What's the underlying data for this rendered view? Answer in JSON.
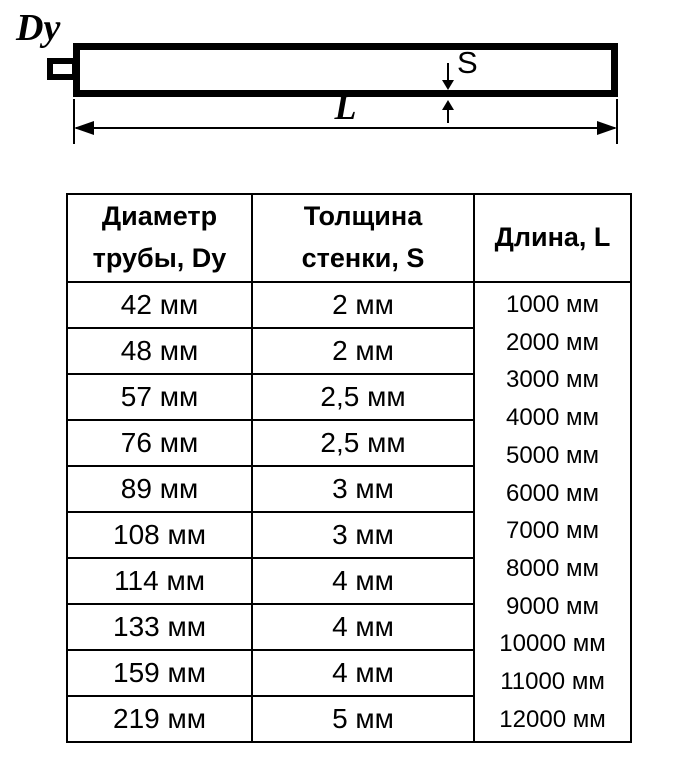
{
  "diagram": {
    "dy_label": "Dy",
    "s_label": "S",
    "l_label": "L"
  },
  "table": {
    "headers": [
      "Диаметр трубы, Dy",
      "Толщина стенки, S",
      "Длина, L"
    ],
    "rows": [
      {
        "diameter": "42 мм",
        "thickness": "2 мм"
      },
      {
        "diameter": "48 мм",
        "thickness": "2 мм"
      },
      {
        "diameter": "57 мм",
        "thickness": "2,5 мм"
      },
      {
        "diameter": "76 мм",
        "thickness": "2,5 мм"
      },
      {
        "diameter": "89 мм",
        "thickness": "3 мм"
      },
      {
        "diameter": "108 мм",
        "thickness": "3 мм"
      },
      {
        "diameter": "114 мм",
        "thickness": "4 мм"
      },
      {
        "diameter": "133 мм",
        "thickness": "4 мм"
      },
      {
        "diameter": "159 мм",
        "thickness": "4 мм"
      },
      {
        "diameter": "219 мм",
        "thickness": "5 мм"
      }
    ],
    "lengths": [
      "1000 мм",
      "2000 мм",
      "3000 мм",
      "4000 мм",
      "5000 мм",
      "6000 мм",
      "7000 мм",
      "8000 мм",
      "9000 мм",
      "10000 мм",
      "11000 мм",
      "12000 мм"
    ]
  },
  "colors": {
    "ink": "#000000",
    "background": "#ffffff"
  }
}
